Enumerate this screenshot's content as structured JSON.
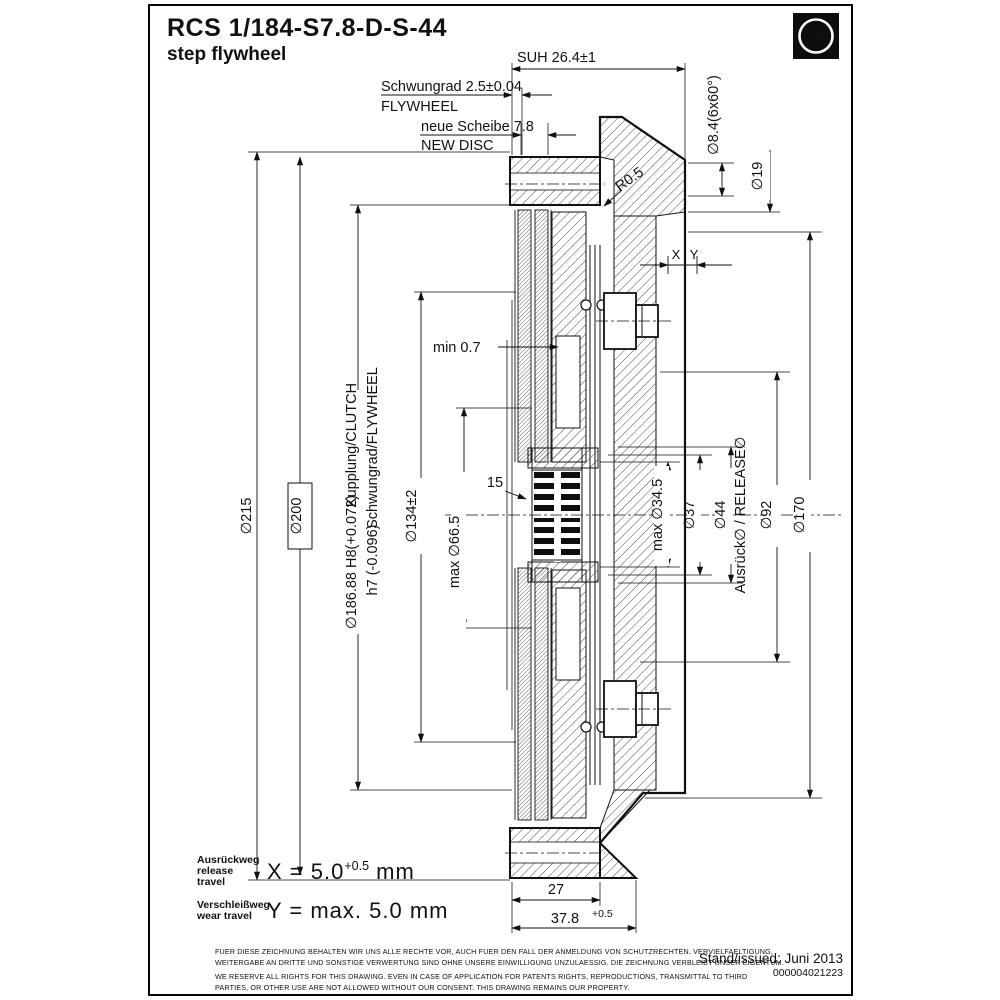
{
  "title": {
    "code": "RCS 1/184-S7.8-D-S-44",
    "subtitle": "step flywheel"
  },
  "logo": "ZF",
  "top_dims": {
    "suh": "SUH 26.4±1",
    "flywheel_de": "Schwungrad 2.5±0.04",
    "flywheel_en": "FLYWHEEL",
    "disc_de": "neue Scheibe 7.8",
    "disc_en": "NEW DISC",
    "bolt_holes": "∅8.4(6x60°)",
    "d19": "∅19",
    "r05": "R0.5",
    "x": "X",
    "y": "Y"
  },
  "left_dims": {
    "d215": "∅215",
    "d200": "∅200",
    "d186": "∅186.88 H8(+0.072)",
    "d186_label": "Kupplung/CLUTCH",
    "h7": "h7 (-0.096)",
    "h7_label": "Schwungrad/FLYWHEEL",
    "d134": "∅134±2",
    "min07": "min 0.7",
    "d66": "max ∅66.5",
    "spline": "15"
  },
  "right_dims": {
    "d34": "max ∅34.5",
    "d37": "∅37",
    "d44": "∅44",
    "release": "Ausrück∅ / RELEASE∅",
    "d92": "∅92",
    "d170": "∅170"
  },
  "bottom_dims": {
    "w27": "27",
    "w378": "37.8",
    "w378_tol": "+0.5"
  },
  "travel_notes": {
    "x_de": "Ausrückweg",
    "x_en": "release travel",
    "x_value": "X = 5.0",
    "x_tol": "+0.5",
    "x_unit": "mm",
    "y_de": "Verschleißweg",
    "y_en": "wear travel",
    "y_value": "Y = max. 5.0 mm"
  },
  "footer": {
    "legal": [
      "FUER DIESE ZEICHNUNG BEHALTEN WIR UNS ALLE RECHTE VOR, AUCH FUER DEN FALL DER ANMELDUNG VON SCHUTZRECHTEN. VERVIELFAELTIGUNG,",
      "WEITERGABE AN DRITTE UND SONSTIGE VERWERTUNG SIND OHNE UNSERE EINWILLIGUNG UNZULAESSIG. DIE ZEICHNUNG VERBLEIBT UNSER EIGENTUM.",
      "WE RESERVE ALL RIGHTS FOR THIS DRAWING. EVEN IN CASE OF APPLICATION FOR PATENTS RIGHTS, REPRODUCTIONS, TRANSMITTAL TO THIRD",
      "PARTIES, OR OTHER USE ARE NOT ALLOWED WITHOUT OUR CONSENT. THIS DRAWING REMAINS OUR PROPERTY."
    ],
    "issued": "Stand/issued: Juni 2013",
    "number": "000004021223"
  }
}
